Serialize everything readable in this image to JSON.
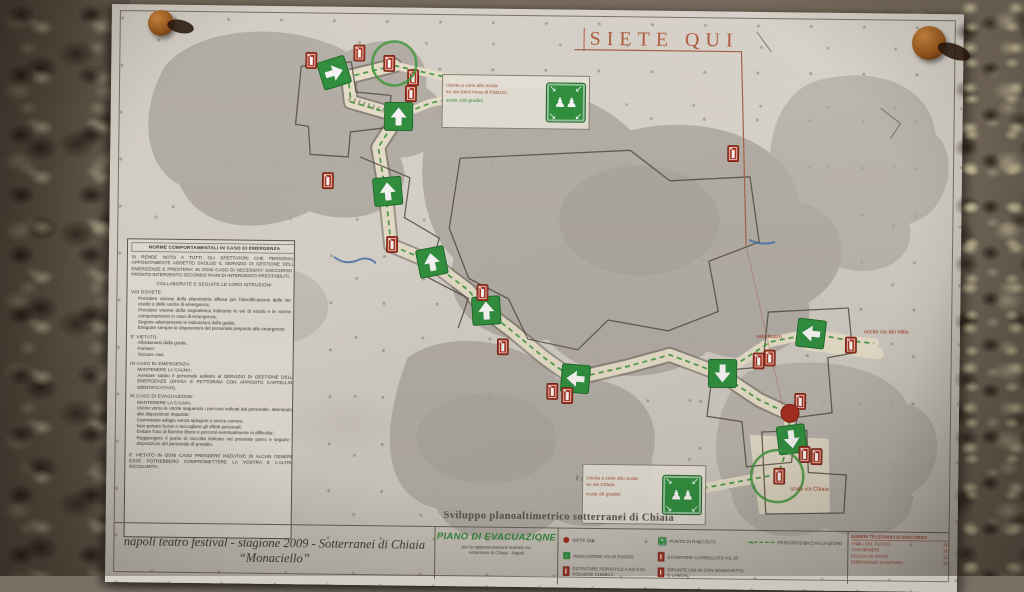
{
  "title": {
    "siete_qui": "SIETE QUI"
  },
  "caption": "Sviluppo planoaltimetrico sotterranei di Chiaia",
  "footer": {
    "production_line1": "napoli teatro festival - stagione 2009 - Sotterranei di Chiaia",
    "production_line2": "“Monaciello”",
    "plan_title": "PIANO DI EVACUAZIONE",
    "plan_subtext": "per la rappresentazione teatrale nei\nsotterranei di Chiaia - Napoli"
  },
  "norme": {
    "title": "NORME COMPORTAMENTALI IN CASO DI EMERGENZA",
    "intro": "SI RENDE NOTO A TUTTI GLI SPETTATORI CHE PERSONALE APPOSITAMENTE ADDETTO SVOLGE IL SERVIZIO DI GESTIONE DELLE EMERGENZE E PRESTERA' IN OGNI CASO DI NECESSITA' SOCCORSO E PRONTO INTERVENTO SECONDO PIANI DI INTERVENTO PRESTABILITI.",
    "collaborate": "COLLABORATE E SEGUITE LE LORO ISTRUZIONI",
    "sections": [
      {
        "heading": "VOI DOVETE:",
        "items": [
          "Prendere visione della planimetria affissa per l'identificazione delle vie di esodo e delle uscite di emergenza;",
          "Prendere visione della segnaletica indicante le vie di esodo e le norme di comportamento in caso di emergenza;",
          "Seguire attentamente le indicazioni della guida;",
          "Eseguire sempre le disposizioni del personale preposto alle emergenze."
        ]
      },
      {
        "heading": "E' VIETATO:",
        "items": [
          "Allontanarsi dalla guida;",
          "Fumare;",
          "Toccare cavi."
        ]
      },
      {
        "heading": "IN CASO DI EMERGENZA:",
        "items": [
          "MANTENERE LA CALMA;",
          "Avvisare subito il personale addetto al SERVIZIO DI GESTIONE DELLE EMERGENZE (DIVISA E PETTORINA CON APPOSITO CARTELLINO IDENTIFICATIVO)."
        ]
      },
      {
        "heading": "IN CASO DI EVACUAZIONE:",
        "items": [
          "MANTENERE LA CALMA;",
          "Uscire verso le uscite seguendo i percorsi indicati dal personale, attenendosi alle disposizioni impartite;",
          "Camminare adagio senza spingere e senza correre;",
          "Non portare borse o raccogliere gli effetti personali;",
          "Evitare l'uso di fiamme libere e percorsi eventualmente in difficolta';",
          "Raggiungere il punto di raccolta indicato nel presente piano e seguire le disposizioni del personale di presidio."
        ]
      }
    ],
    "warning": "E' VIETATO IN OGNI CASO PRENDERE INIZIATIVE DI ALCUN GENERE: ESSE POTREBBERO COMPROMETTERE LA VOSTRA E L'ALTRUI INCOLUMITA'."
  },
  "legend": {
    "items": [
      {
        "icon": "you-are-here-dot",
        "label": "SIETE QUI"
      },
      {
        "icon": "assembly-point-icon",
        "label": "PUNTO DI RACCOLTA"
      },
      {
        "icon": "route-dashed-line",
        "label": "PERCORSO DI EVACUAZIONE"
      },
      {
        "icon": "exit-sign-icon",
        "label": "INDICAZIONE VIA DI ESODO"
      },
      {
        "icon": "extinguisher-icon",
        "label": "ESTINTORE CARRELLATO KG 30"
      },
      {
        "icon": "extinguisher-icon",
        "label": "ESTINTORE PORTATILE A KG 6 DI POLVERE CHIMICA"
      },
      {
        "icon": "extinguisher-icon",
        "label": "IDRANTE UNI 45 CON MANICHETTA E LANCIA"
      }
    ]
  },
  "phone_table": {
    "title": "NUMERI TELEFONICI DI SOCCORSO",
    "rows": [
      {
        "name": "VIGILI DEL FUOCO",
        "number": "115"
      },
      {
        "name": "CARABINIERI",
        "number": "112"
      },
      {
        "name": "POLIZIA DI STATO",
        "number": "113"
      },
      {
        "name": "EMERGENZA SANITARIA",
        "number": "118"
      }
    ]
  },
  "assembly_boxes": [
    {
      "lines": [
        "Uscita a cielo alto scala",
        "su via Sant'Anna di Palazzo",
        "scala 100 gradini"
      ]
    },
    {
      "lines": [
        "Uscita a cielo alto scala",
        "su via Chiaia",
        "scala 96 gradini"
      ]
    }
  ],
  "map": {
    "labels": [
      {
        "text": "sala teatro",
        "x": 648,
        "y": 326
      },
      {
        "text": "uscita via dei Mille",
        "x": 756,
        "y": 320
      },
      {
        "text": "scala via Chiaia",
        "x": 684,
        "y": 478
      }
    ],
    "exit_signs": [
      {
        "x": 223,
        "y": 66,
        "dir": "right",
        "rot": -18
      },
      {
        "x": 288,
        "y": 109,
        "dir": "up",
        "rot": 0
      },
      {
        "x": 278,
        "y": 184,
        "dir": "up",
        "rot": -6
      },
      {
        "x": 323,
        "y": 254,
        "dir": "up",
        "rot": -12
      },
      {
        "x": 378,
        "y": 302,
        "dir": "up",
        "rot": -4
      },
      {
        "x": 468,
        "y": 369,
        "dir": "left",
        "rot": 4
      },
      {
        "x": 703,
        "y": 321,
        "dir": "left",
        "rot": 6
      },
      {
        "x": 615,
        "y": 362,
        "dir": "down",
        "rot": 0
      },
      {
        "x": 685,
        "y": 427,
        "dir": "down",
        "rot": -8
      }
    ],
    "extinguishers": [
      [
        200,
        54
      ],
      [
        248,
        46
      ],
      [
        278,
        56
      ],
      [
        302,
        70
      ],
      [
        300,
        86
      ],
      [
        218,
        174
      ],
      [
        283,
        237
      ],
      [
        374,
        284
      ],
      [
        395,
        338
      ],
      [
        445,
        382
      ],
      [
        460,
        386
      ],
      [
        623,
        142
      ],
      [
        651,
        349
      ],
      [
        662,
        346
      ],
      [
        743,
        332
      ],
      [
        693,
        389
      ],
      [
        698,
        442
      ],
      [
        710,
        444
      ],
      [
        673,
        464
      ]
    ],
    "you_are_here": {
      "x": 683,
      "y": 401,
      "r": 9
    },
    "highlight_circles": [
      {
        "x": 283,
        "y": 56,
        "r": 22
      },
      {
        "x": 671,
        "y": 464,
        "r": 26
      }
    ]
  },
  "colors": {
    "paper": "#d8d4cc",
    "rock": "#756b5e",
    "sign_green": "#2e9340",
    "route_green": "#3f9b3f",
    "extinguisher_red": "#ac3322",
    "you_are_here_red": "#a82c1e",
    "title_red": "#b15a3e",
    "legend_red": "#9c3a28",
    "cave_gray": "#b3afa8",
    "corridor_cream": "#ece5d0"
  },
  "icons": [
    "exit-sign-icon",
    "extinguisher-icon",
    "assembly-point-icon",
    "you-are-here-dot",
    "pushpin-icon"
  ]
}
